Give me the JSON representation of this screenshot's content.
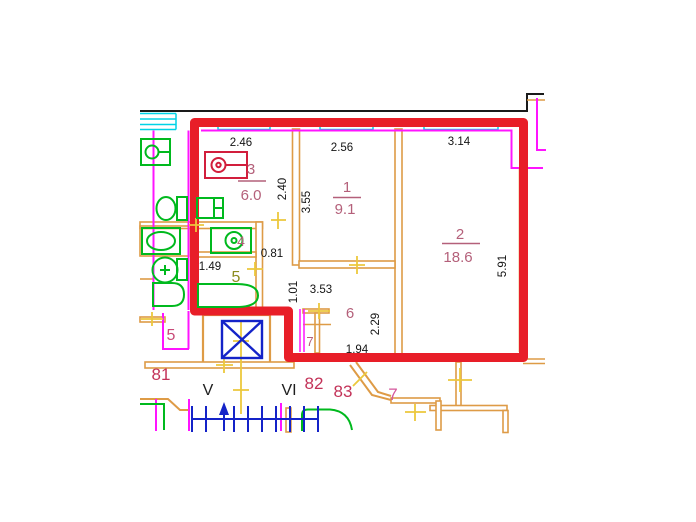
{
  "title": "Apartment floor plan — unit 82 highlighted with red boundary",
  "colors": {
    "boundary_red": "#e81e28",
    "wall_orange": "#de9b46",
    "opening_magenta": "#ff14ff",
    "window_cyan": "#00d2e6",
    "fixture_green": "#00b91e",
    "elevator_blue": "#1423c8",
    "tick_yellow": "#ecc83c",
    "room_label_rose": "#b4607a",
    "unit_label_crimson": "#c33258",
    "bath_label_olive": "#8c8c1e",
    "outline_black": "#1a1a1a"
  },
  "rooms": [
    {
      "number": "3",
      "area": "6.0"
    },
    {
      "number": "1",
      "area": "9.1"
    },
    {
      "number": "2",
      "area": "18.6"
    },
    {
      "number": "6",
      "area": ""
    },
    {
      "number": "4",
      "area": ""
    },
    {
      "number": "5",
      "area": ""
    },
    {
      "number": "7",
      "area": ""
    }
  ],
  "dims": [
    "2.46",
    "2.56",
    "3.14",
    "2.40",
    "3.55",
    "0.81",
    "1.49",
    "1.01",
    "3.53",
    "2.29",
    "1.94",
    "5.91"
  ],
  "units": {
    "u81": "81",
    "u82": "82",
    "u83": "83",
    "u7": "7",
    "u5": "5"
  },
  "sections": {
    "v": "V",
    "vi": "VI"
  },
  "fixtures": [
    "stove",
    "kitchen-sink",
    "washing-machine",
    "bathtub",
    "toilet",
    "washbasin",
    "elevator",
    "stairs",
    "window"
  ]
}
